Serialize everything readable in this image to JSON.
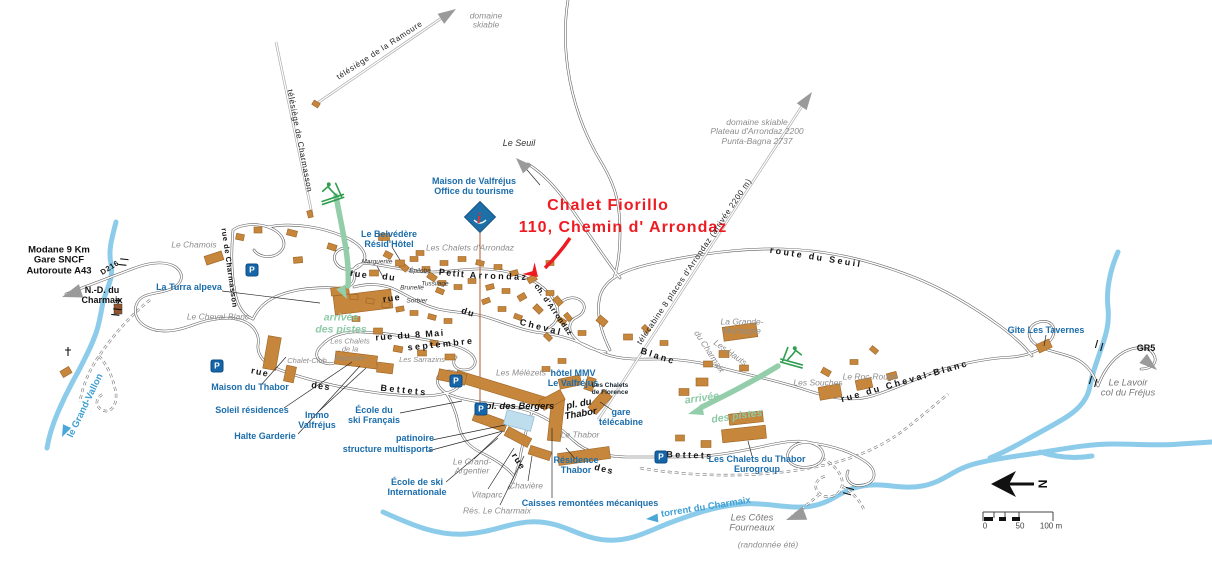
{
  "map": {
    "annotation": {
      "line1": "Chalet Fiorillo",
      "line2": "110, Chemin d' Arrondaz"
    },
    "colors": {
      "accent_red": "#ee1b22",
      "label_blue": "#1b6dab",
      "river_blue": "#8cccea",
      "building_orange": "#c6863b",
      "piste_green": "#8cc9a6",
      "parking_blue": "#1565a8"
    },
    "scale_bar": {
      "ticks": [
        "0",
        "50",
        "100 m"
      ]
    },
    "labels": [
      {
        "name": "label-domaine-skiable-top",
        "text": "domaine\nskiable",
        "x": 486,
        "y": 21,
        "cls": "gray",
        "rot": 0
      },
      {
        "name": "label-telesiege-ramoure",
        "text": "télésiège de la Ramoure",
        "x": 380,
        "y": 51,
        "cls": "lift",
        "rot": -33
      },
      {
        "name": "label-telesiege-charmasson",
        "text": "télésiège de Charmasson",
        "x": 299,
        "y": 141,
        "cls": "lift",
        "rot": 79
      },
      {
        "name": "label-domaine-skiable-right",
        "text": "domaine skiable\nPlateau d'Arrondaz 2200\nPunta-Bagna 2737",
        "x": 757,
        "y": 132,
        "cls": "gray",
        "rot": 0
      },
      {
        "name": "label-le-seuil",
        "text": "Le Seuil",
        "x": 519,
        "y": 144,
        "cls": "black-it",
        "rot": 0
      },
      {
        "name": "label-maison-valfrejus",
        "text": "Maison de Valfréjus\nOffice du tourisme",
        "x": 474,
        "y": 187,
        "cls": "blue",
        "rot": 0
      },
      {
        "name": "label-chalet-fiorillo",
        "text": "Chalet Fiorillo",
        "x": 608,
        "y": 206,
        "cls": "red",
        "rot": 0
      },
      {
        "name": "label-chemin-arrondaz-red",
        "text": "110, Chemin d' Arrondaz",
        "x": 623,
        "y": 228,
        "cls": "red",
        "rot": 0
      },
      {
        "name": "label-le-chamois",
        "text": "Le Chamois",
        "x": 194,
        "y": 245,
        "cls": "gray",
        "rot": 0
      },
      {
        "name": "label-modane",
        "text": "Modane 9 Km\nGare SNCF\nAutoroute A43",
        "x": 59,
        "y": 261,
        "cls": "black",
        "rot": 0
      },
      {
        "name": "label-d216",
        "text": "D216",
        "x": 110,
        "y": 268,
        "cls": "road-sm",
        "rot": -32
      },
      {
        "name": "label-nd-charmaix",
        "text": "N.-D. du\nCharmaix",
        "x": 102,
        "y": 296,
        "cls": "black-md",
        "rot": 0
      },
      {
        "name": "label-la-turra",
        "text": "La Turra alpeva",
        "x": 189,
        "y": 288,
        "cls": "blue",
        "rot": 0
      },
      {
        "name": "label-belvedere",
        "text": "Le Belvédère\nRésid'Hôtel",
        "x": 389,
        "y": 240,
        "cls": "blue",
        "rot": 0
      },
      {
        "name": "label-chalets-arrondaz",
        "text": "Les Chalets d'Arrondaz",
        "x": 470,
        "y": 248,
        "cls": "gray",
        "rot": 0
      },
      {
        "name": "label-marguerite",
        "text": "Marguerite",
        "x": 377,
        "y": 262,
        "cls": "resid",
        "rot": 0
      },
      {
        "name": "label-epilobe",
        "text": "Épilobe",
        "x": 420,
        "y": 271,
        "cls": "resid",
        "rot": 0
      },
      {
        "name": "label-brunelle",
        "text": "Brunelle",
        "x": 412,
        "y": 288,
        "cls": "resid",
        "rot": 0
      },
      {
        "name": "label-tussilage",
        "text": "Tussilage",
        "x": 435,
        "y": 284,
        "cls": "resid",
        "rot": 0
      },
      {
        "name": "label-sorbier",
        "text": "Sorbier",
        "x": 417,
        "y": 301,
        "cls": "resid",
        "rot": 0
      },
      {
        "name": "road-label-rue-1",
        "text": "rue",
        "x": 359,
        "y": 275,
        "cls": "road",
        "rot": 8
      },
      {
        "name": "road-label-du-1",
        "text": "du",
        "x": 389,
        "y": 278,
        "cls": "road",
        "rot": 8
      },
      {
        "name": "road-label-petit",
        "text": "Petit",
        "x": 452,
        "y": 274,
        "cls": "road",
        "rot": 6
      },
      {
        "name": "road-label-arrondaz",
        "text": "Arrondaz",
        "x": 499,
        "y": 277,
        "cls": "road ls2",
        "rot": 2
      },
      {
        "name": "road-label-rue-2",
        "text": "rue",
        "x": 392,
        "y": 299,
        "cls": "road",
        "rot": -8
      },
      {
        "name": "road-label-du-2",
        "text": "du",
        "x": 468,
        "y": 313,
        "cls": "road",
        "rot": 18
      },
      {
        "name": "road-label-cheval",
        "text": "Cheval",
        "x": 541,
        "y": 328,
        "cls": "road ls2",
        "rot": 14
      },
      {
        "name": "road-label-blanc",
        "text": "Blanc",
        "x": 658,
        "y": 357,
        "cls": "road ls2",
        "rot": 18
      },
      {
        "name": "road-label-ch-arrondaz",
        "text": "ch. d'Arrondaz",
        "x": 553,
        "y": 310,
        "cls": "road-sm",
        "rot": 55
      },
      {
        "name": "label-telecabine-arrondaz",
        "text": "télécabine 8 places d'Arrondaz (arrivée 2200 m)",
        "x": 695,
        "y": 262,
        "cls": "lift",
        "rot": -56
      },
      {
        "name": "road-label-route-du-seuil",
        "text": "route du Seuil",
        "x": 816,
        "y": 258,
        "cls": "road ls2",
        "rot": 9
      },
      {
        "name": "road-label-rue-8-mai",
        "text": "rue du 8 Mai",
        "x": 410,
        "y": 336,
        "cls": "road",
        "rot": -4
      },
      {
        "name": "road-label-septembre",
        "text": "septembre",
        "x": 441,
        "y": 345,
        "cls": "road ls2",
        "rot": -6
      },
      {
        "name": "label-cheval-blanc-res",
        "text": "Le Cheval-Blanc",
        "x": 218,
        "y": 317,
        "cls": "gray",
        "rot": 0
      },
      {
        "name": "road-label-rue-de-charmasson",
        "text": "rue de Charmasson",
        "x": 229,
        "y": 268,
        "cls": "road-sm",
        "rot": 82
      },
      {
        "name": "label-arrivee-pistes-left",
        "text": "arrivée\ndes pistes",
        "x": 341,
        "y": 324,
        "cls": "green",
        "rot": 0
      },
      {
        "name": "label-chalets-ramoure",
        "text": "Les Chalets\nde la\nRamoure",
        "x": 350,
        "y": 350,
        "cls": "gray-sm",
        "rot": 0
      },
      {
        "name": "label-chalet-club",
        "text": "Chalet-Club",
        "x": 307,
        "y": 361,
        "cls": "gray-sm",
        "rot": 0
      },
      {
        "name": "label-sarrazins",
        "text": "Les Sarrazins",
        "x": 422,
        "y": 360,
        "cls": "gray-sm",
        "rot": 0
      },
      {
        "name": "label-maison-thabor",
        "text": "Maison du Thabor",
        "x": 250,
        "y": 388,
        "cls": "blue",
        "rot": 0
      },
      {
        "name": "label-soleil-residences",
        "text": "Soleil résidences",
        "x": 252,
        "y": 411,
        "cls": "blue",
        "rot": 0
      },
      {
        "name": "label-halte-garderie",
        "text": "Halte Garderie",
        "x": 265,
        "y": 437,
        "cls": "blue",
        "rot": 0
      },
      {
        "name": "label-immo-valfrejus",
        "text": "Immo\nValfréjus",
        "x": 317,
        "y": 421,
        "cls": "blue",
        "rot": 0
      },
      {
        "name": "road-label-rue-3",
        "text": "rue",
        "x": 260,
        "y": 373,
        "cls": "road",
        "rot": 12
      },
      {
        "name": "road-label-des-1",
        "text": "des",
        "x": 321,
        "y": 387,
        "cls": "road",
        "rot": 8
      },
      {
        "name": "road-label-bettets-1",
        "text": "Bettets",
        "x": 404,
        "y": 391,
        "cls": "road ls2",
        "rot": 6
      },
      {
        "name": "label-ecole-ski-francais",
        "text": "École du\nski Français",
        "x": 374,
        "y": 416,
        "cls": "blue",
        "rot": 0
      },
      {
        "name": "label-patinoire",
        "text": "patinoire",
        "x": 415,
        "y": 439,
        "cls": "blue",
        "rot": 0
      },
      {
        "name": "label-structure-multisports",
        "text": "structure multisports",
        "x": 388,
        "y": 450,
        "cls": "blue",
        "rot": 0
      },
      {
        "name": "label-melezets",
        "text": "Les Mélèzets",
        "x": 521,
        "y": 373,
        "cls": "gray",
        "rot": 0
      },
      {
        "name": "label-pl-des-bergers",
        "text": "pl. des Bergers",
        "x": 520,
        "y": 407,
        "cls": "place",
        "rot": 0
      },
      {
        "name": "label-pl-du-thabor",
        "text": "pl. du\nThabor",
        "x": 580,
        "y": 410,
        "cls": "place",
        "rot": -10
      },
      {
        "name": "label-hotel-mmv",
        "text": "hôtel MMV\nLe Valfréjus",
        "x": 573,
        "y": 379,
        "cls": "blue",
        "rot": 0
      },
      {
        "name": "label-chalets-florence",
        "text": "Les Chalets\nde Florence",
        "x": 610,
        "y": 389,
        "cls": "florence",
        "rot": 0
      },
      {
        "name": "label-gare-telecabine",
        "text": "gare\ntélécabine",
        "x": 621,
        "y": 418,
        "cls": "blue",
        "rot": 0
      },
      {
        "name": "label-le-thabor",
        "text": "Le Thabor",
        "x": 580,
        "y": 435,
        "cls": "gray",
        "rot": 0
      },
      {
        "name": "label-residence-thabor",
        "text": "Résidence\nThabor",
        "x": 576,
        "y": 466,
        "cls": "blue",
        "rot": 0
      },
      {
        "name": "label-grand-argentier",
        "text": "Le Grand-\nArgentier",
        "x": 472,
        "y": 467,
        "cls": "gray",
        "rot": 0
      },
      {
        "name": "label-vitaparc",
        "text": "Vitaparc",
        "x": 487,
        "y": 495,
        "cls": "gray",
        "rot": 0
      },
      {
        "name": "label-res-le-charmaix",
        "text": "Rés. Le Charmaix",
        "x": 497,
        "y": 511,
        "cls": "gray",
        "rot": 0
      },
      {
        "name": "label-chaviere",
        "text": "Chavière",
        "x": 526,
        "y": 486,
        "cls": "gray",
        "rot": 0
      },
      {
        "name": "label-caisses-remontees",
        "text": "Caisses remontées mécaniques",
        "x": 590,
        "y": 504,
        "cls": "blue",
        "rot": 0
      },
      {
        "name": "label-ecole-ski-internationale",
        "text": "École de ski\nInternationale",
        "x": 417,
        "y": 488,
        "cls": "blue",
        "rot": 0
      },
      {
        "name": "road-label-rue-4",
        "text": "rue",
        "x": 518,
        "y": 462,
        "cls": "road",
        "rot": 58
      },
      {
        "name": "road-label-des-2",
        "text": "des",
        "x": 604,
        "y": 470,
        "cls": "road",
        "rot": 14
      },
      {
        "name": "road-label-bettets-2",
        "text": "Bettets",
        "x": 690,
        "y": 456,
        "cls": "road ls2",
        "rot": 2
      },
      {
        "name": "label-chalets-du-thabor",
        "text": "Les Chalets du Thabor\nEurogroup",
        "x": 757,
        "y": 465,
        "cls": "blue",
        "rot": 0
      },
      {
        "name": "label-arrivee-right-1",
        "text": "arrivée",
        "x": 702,
        "y": 399,
        "cls": "green",
        "rot": -8
      },
      {
        "name": "label-arrivee-right-2",
        "text": "des pistes",
        "x": 737,
        "y": 417,
        "cls": "green",
        "rot": -8
      },
      {
        "name": "label-grande-montagne",
        "text": "La Grande-\nMontagne",
        "x": 742,
        "y": 327,
        "cls": "gray",
        "rot": 0
      },
      {
        "name": "label-les-hauts",
        "text": "Les Hauts",
        "x": 730,
        "y": 353,
        "cls": "gray",
        "rot": 35
      },
      {
        "name": "label-du-charmaix",
        "text": "du Charmaix",
        "x": 709,
        "y": 352,
        "cls": "gray",
        "rot": 57
      },
      {
        "name": "label-les-souches",
        "text": "Les Souches",
        "x": 818,
        "y": 383,
        "cls": "gray",
        "rot": 0
      },
      {
        "name": "label-roc-rouge",
        "text": "Le Roc-Rouge",
        "x": 870,
        "y": 377,
        "cls": "gray",
        "rot": 0
      },
      {
        "name": "road-label-rue-cheval-blanc",
        "text": "rue du Cheval-Blanc",
        "x": 905,
        "y": 382,
        "cls": "road ls2",
        "rot": -16
      },
      {
        "name": "label-gite-les-tavernes",
        "text": "Gîte Les Tavernes",
        "x": 1046,
        "y": 331,
        "cls": "blue",
        "rot": 0
      },
      {
        "name": "label-gr5",
        "text": "GR5",
        "x": 1146,
        "y": 349,
        "cls": "black-md",
        "rot": 0
      },
      {
        "name": "label-le-lavoir",
        "text": "Le Lavoir\ncol du Fréjus",
        "x": 1128,
        "y": 389,
        "cls": "gray-lg",
        "rot": 0
      },
      {
        "name": "label-torrent-charmaix",
        "text": "torrent du Charmaix",
        "x": 706,
        "y": 508,
        "cls": "river",
        "rot": -9
      },
      {
        "name": "label-grand-vallon",
        "text": "le Grand-Vallon",
        "x": 86,
        "y": 406,
        "cls": "river",
        "rot": -64
      },
      {
        "name": "label-cotes-fourneaux",
        "text": "Les Côtes\nFourneaux",
        "x": 752,
        "y": 524,
        "cls": "gray-lg",
        "rot": 0
      },
      {
        "name": "label-randonnee-ete",
        "text": "(randonnée été)",
        "x": 768,
        "y": 545,
        "cls": "gray",
        "rot": 0
      },
      {
        "name": "parking-icon",
        "text": "P",
        "x": 252,
        "y": 270,
        "cls": "p-icon",
        "rot": 0
      },
      {
        "name": "parking-icon",
        "text": "P",
        "x": 217,
        "y": 366,
        "cls": "p-icon",
        "rot": 0
      },
      {
        "name": "parking-icon",
        "text": "P",
        "x": 456,
        "y": 381,
        "cls": "p-icon",
        "rot": 0
      },
      {
        "name": "parking-icon",
        "text": "P",
        "x": 481,
        "y": 409,
        "cls": "p-icon",
        "rot": 0
      },
      {
        "name": "parking-icon",
        "text": "P",
        "x": 661,
        "y": 457,
        "cls": "p-icon",
        "rot": 0
      },
      {
        "name": "compass-north-letter",
        "text": "N",
        "x": 1042,
        "y": 484,
        "cls": "compass",
        "rot": 90
      },
      {
        "name": "scale-tick-0",
        "text": "0",
        "x": 985,
        "y": 527,
        "cls": "scale",
        "rot": 0
      },
      {
        "name": "scale-tick-50",
        "text": "50",
        "x": 1020,
        "y": 527,
        "cls": "scale",
        "rot": 0
      },
      {
        "name": "scale-tick-100",
        "text": "100 m",
        "x": 1051,
        "y": 527,
        "cls": "scale",
        "rot": 0
      }
    ]
  }
}
